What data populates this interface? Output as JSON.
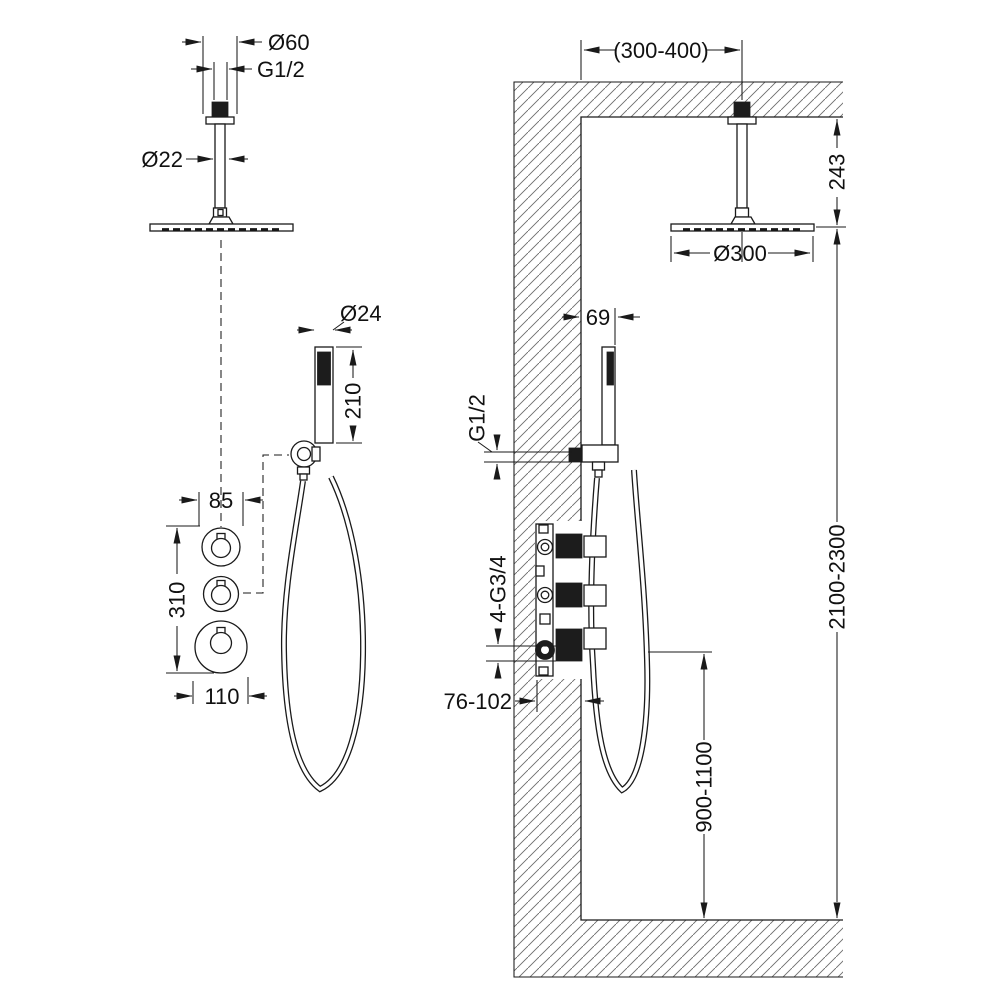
{
  "drawing": {
    "type": "shower-system-installation-diagram",
    "line_color": "#1a1a1a",
    "background": "#ffffff",
    "left_view": {
      "ceiling_shower": {
        "flange_diameter": "Ø60",
        "ceiling_thread": "G1/2",
        "arm_diameter": "Ø22"
      },
      "hand_shower": {
        "handle_diameter": "Ø24",
        "handle_length": "210"
      },
      "valve_trim": {
        "upper_escutcheon_diameter": "85",
        "trim_total_height": "310",
        "lower_escutcheon_diameter": "110"
      }
    },
    "right_view": {
      "head_offset_from_wall": "(300-400)",
      "arm_drop_from_ceiling": "243",
      "head_diameter": "Ø300",
      "hand_shower_offset": "69",
      "outlet_thread": "G1/2",
      "valve_connections": "4-G3/4",
      "rough_in_depth": "76-102",
      "valve_height_from_floor": "900-1100",
      "head_height_from_floor": "2100-2300"
    }
  }
}
